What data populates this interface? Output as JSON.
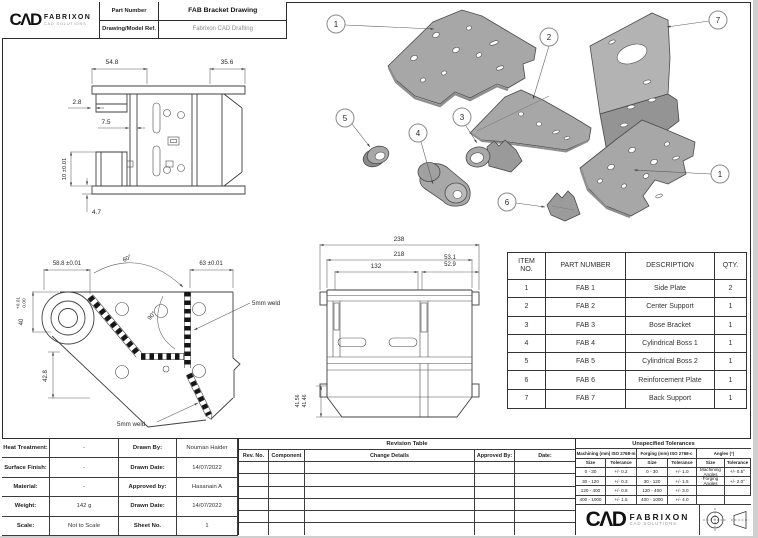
{
  "title_block": {
    "brand": "CΛD",
    "brand_name": "FABRIXON",
    "brand_sub": "CAD SOLUTIONS",
    "part_number_label": "Part Number",
    "part_number_value": "FAB Bracket Drawing",
    "model_ref_label": "Drawing/Model Ref.",
    "model_ref_value": "Fabrixon CAD Drafting"
  },
  "dims": {
    "side": {
      "top_left": "54.8",
      "top_right": "35.6",
      "step": "2.8",
      "plate": "7.5",
      "boss": "10 ±0.01",
      "flange": "4.7"
    },
    "detail": {
      "width": "58.8 ±0.01",
      "height": "40",
      "height_tol_up": "+0.01",
      "height_tol_low": "0.00",
      "right": "63 ±0.01",
      "angle_top": "60°",
      "angle_mid": "90°",
      "lower": "42.8",
      "weld_right": "5mm weld",
      "weld_bottom": "5mm weld"
    },
    "front": {
      "overall": "238",
      "inner": "218",
      "slot_span": "132",
      "right_top": "53.1",
      "right_bottom": "52.9",
      "skirt_outer": "41.56",
      "skirt_inner": "41.46"
    }
  },
  "balloons": {
    "side_plate_top": "1",
    "center_support": "2",
    "back_support": "7",
    "cyl_boss_2": "5",
    "cyl_boss_1": "4",
    "bose_bracket": "3",
    "reinforcement": "6",
    "side_plate_right": "1"
  },
  "parts_table": {
    "headers": {
      "item": "ITEM\nNO.",
      "part": "PART NUMBER",
      "desc": "DESCRIPTION",
      "qty": "QTY."
    },
    "rows": [
      {
        "item": "1",
        "part": "FAB 1",
        "desc": "Side Plate",
        "qty": "2"
      },
      {
        "item": "2",
        "part": "FAB 2",
        "desc": "Center Support",
        "qty": "1"
      },
      {
        "item": "3",
        "part": "FAB 3",
        "desc": "Bose Bracket",
        "qty": "1"
      },
      {
        "item": "4",
        "part": "FAB 4",
        "desc": "Cylindrical Boss 1",
        "qty": "1"
      },
      {
        "item": "5",
        "part": "FAB 5",
        "desc": "Cylindrical Boss 2",
        "qty": "1"
      },
      {
        "item": "6",
        "part": "FAB 6",
        "desc": "Reinforcement Plate",
        "qty": "1"
      },
      {
        "item": "7",
        "part": "FAB 7",
        "desc": "Back Support",
        "qty": "1"
      }
    ]
  },
  "info_block": {
    "rows": [
      {
        "l1": "Heat Treatment:",
        "v1": "-",
        "l2": "Drawn By:",
        "v2": "Nouman Haider"
      },
      {
        "l1": "Surface Finish:",
        "v1": "-",
        "l2": "Drawn Date:",
        "v2": "14/07/2022"
      },
      {
        "l1": "Material:",
        "v1": "-",
        "l2": "Approved by:",
        "v2": "Hasanain A"
      },
      {
        "l1": "Weight:",
        "v1": "142 g",
        "l2": "Drawn Date:",
        "v2": "14/07/2022"
      },
      {
        "l1": "Scale:",
        "v1": "Not to Scale",
        "l2": "Sheet No.",
        "v2": "1"
      }
    ]
  },
  "revision_table": {
    "title": "Revision Table",
    "headers": [
      "Rev. No.",
      "Component",
      "Change Details",
      "Approved By:",
      "Date:"
    ]
  },
  "tolerances": {
    "title": "Unspecified Tolerances",
    "machining_header": "Machining (mm) ISO 2768-m",
    "forging_header": "Forging (mm) ISO 2768-c",
    "angles_header": "Angles (°)",
    "size_label": "Size",
    "tolerance_label": "Tolerance",
    "machining_rows": [
      [
        "0 - 30",
        "+/- 0.2"
      ],
      [
        "30 - 120",
        "+/- 0.3"
      ],
      [
        "120 - 400",
        "+/- 0.8"
      ],
      [
        "400 - 1000",
        "+/- 1.5"
      ]
    ],
    "forging_rows": [
      [
        "0 - 30",
        "+/- 1.0"
      ],
      [
        "30 - 120",
        "+/- 1.5"
      ],
      [
        "120 - 400",
        "+/- 3.0"
      ],
      [
        "400 - 1000",
        "+/- 4.0"
      ]
    ],
    "angles_rows": [
      [
        "Machining Angles",
        "+/- 0.5°"
      ],
      [
        "Forging Angles",
        "+/- 2.0°"
      ]
    ]
  },
  "footer": {
    "brand": "CΛD",
    "brand_name": "FABRIXON",
    "brand_sub": "CAD SOLUTIONS"
  },
  "colors": {
    "line": "#3f3f3f",
    "part_gray": "#a7a7a7",
    "part_light": "#b9b9b9",
    "part_dark": "#8e8e8e"
  }
}
